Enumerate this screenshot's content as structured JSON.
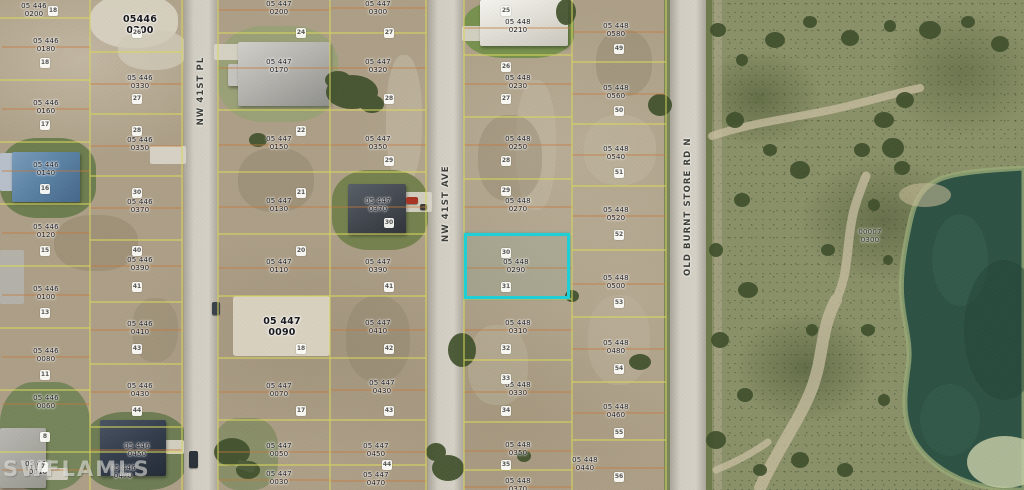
{
  "map": {
    "watermark": "SWFLAMLS",
    "type_note": "aerial parcel map"
  },
  "streets": {
    "pl": "NW 41ST PL",
    "ave": "NW 41ST AVE",
    "obs": "OLD BURNT STORE RD N"
  },
  "highlight": {
    "parcel": "05 448 0290",
    "border_color": "#1fd0d6"
  },
  "colors": {
    "parcel_line_yellow": "#d9d75e",
    "lot_line_orange": "#c47a3c",
    "water": "#2e5244",
    "road": "#d1cdc2",
    "ground": "#ad9f87",
    "vegetation": "#8a9068"
  },
  "parcels": [
    {
      "l1": "05 446",
      "l2": "0200"
    },
    {
      "l1": "05 446",
      "l2": "0180"
    },
    {
      "l1": "05 446",
      "l2": "0160"
    },
    {
      "l1": "05 446",
      "l2": "0140"
    },
    {
      "l1": "05 446",
      "l2": "0120"
    },
    {
      "l1": "05 446",
      "l2": "0100"
    },
    {
      "l1": "05 446",
      "l2": "0080"
    },
    {
      "l1": "05 446",
      "l2": "0060"
    },
    {
      "l1": "05 446",
      "l2": "0010"
    },
    {
      "l1": "05446",
      "l2": "0300"
    },
    {
      "l1": "05 446",
      "l2": "0330"
    },
    {
      "l1": "05 446",
      "l2": "0350"
    },
    {
      "l1": "05 446",
      "l2": "0370"
    },
    {
      "l1": "05 446",
      "l2": "0390"
    },
    {
      "l1": "05 446",
      "l2": "0410"
    },
    {
      "l1": "05 446",
      "l2": "0430"
    },
    {
      "l1": "05 446",
      "l2": "0450"
    },
    {
      "l1": "05 446",
      "l2": "0470"
    },
    {
      "l1": "05 447",
      "l2": "0200"
    },
    {
      "l1": "05 447",
      "l2": "0170"
    },
    {
      "l1": "05 447",
      "l2": "0150"
    },
    {
      "l1": "05 447",
      "l2": "0130"
    },
    {
      "l1": "05 447",
      "l2": "0110"
    },
    {
      "l1": "05 447",
      "l2": "0090"
    },
    {
      "l1": "05 447",
      "l2": "0070"
    },
    {
      "l1": "05 447",
      "l2": "0050"
    },
    {
      "l1": "05 447",
      "l2": "0030"
    },
    {
      "l1": "05 447",
      "l2": "0300"
    },
    {
      "l1": "05 447",
      "l2": "0320"
    },
    {
      "l1": "05 447",
      "l2": "0350"
    },
    {
      "l1": "05 447",
      "l2": "0370"
    },
    {
      "l1": "05 447",
      "l2": "0390"
    },
    {
      "l1": "05 447",
      "l2": "0410"
    },
    {
      "l1": "05 447",
      "l2": "0430"
    },
    {
      "l1": "05 447",
      "l2": "0450"
    },
    {
      "l1": "05 447",
      "l2": "0470"
    },
    {
      "l1": "05 448",
      "l2": "0210"
    },
    {
      "l1": "05 448",
      "l2": "0230"
    },
    {
      "l1": "05 448",
      "l2": "0250"
    },
    {
      "l1": "05 448",
      "l2": "0270"
    },
    {
      "l1": "05 448",
      "l2": "0290"
    },
    {
      "l1": "05 448",
      "l2": "0310"
    },
    {
      "l1": "05 448",
      "l2": "0330"
    },
    {
      "l1": "05 448",
      "l2": "0350"
    },
    {
      "l1": "05 448",
      "l2": "0370"
    },
    {
      "l1": "05 448",
      "l2": "0580"
    },
    {
      "l1": "05 448",
      "l2": "0560"
    },
    {
      "l1": "05 448",
      "l2": "0540"
    },
    {
      "l1": "05 448",
      "l2": "0520"
    },
    {
      "l1": "05 448",
      "l2": "0500"
    },
    {
      "l1": "05 448",
      "l2": "0480"
    },
    {
      "l1": "05 448",
      "l2": "0460"
    },
    {
      "l1": "05 448",
      "l2": "0440"
    },
    {
      "l1": "00007",
      "l2": "0300"
    }
  ],
  "lot_numbers": [
    "18",
    "18",
    "17",
    "16",
    "15",
    "13",
    "11",
    "8",
    "7",
    "26",
    "27",
    "28",
    "30",
    "40",
    "41",
    "43",
    "44",
    "24",
    "22",
    "21",
    "20",
    "18",
    "17",
    "27",
    "28",
    "29",
    "30",
    "41",
    "42",
    "43",
    "44",
    "25",
    "26",
    "27",
    "28",
    "29",
    "30",
    "31",
    "32",
    "33",
    "34",
    "35",
    "49",
    "50",
    "51",
    "52",
    "53",
    "54",
    "55",
    "56"
  ]
}
